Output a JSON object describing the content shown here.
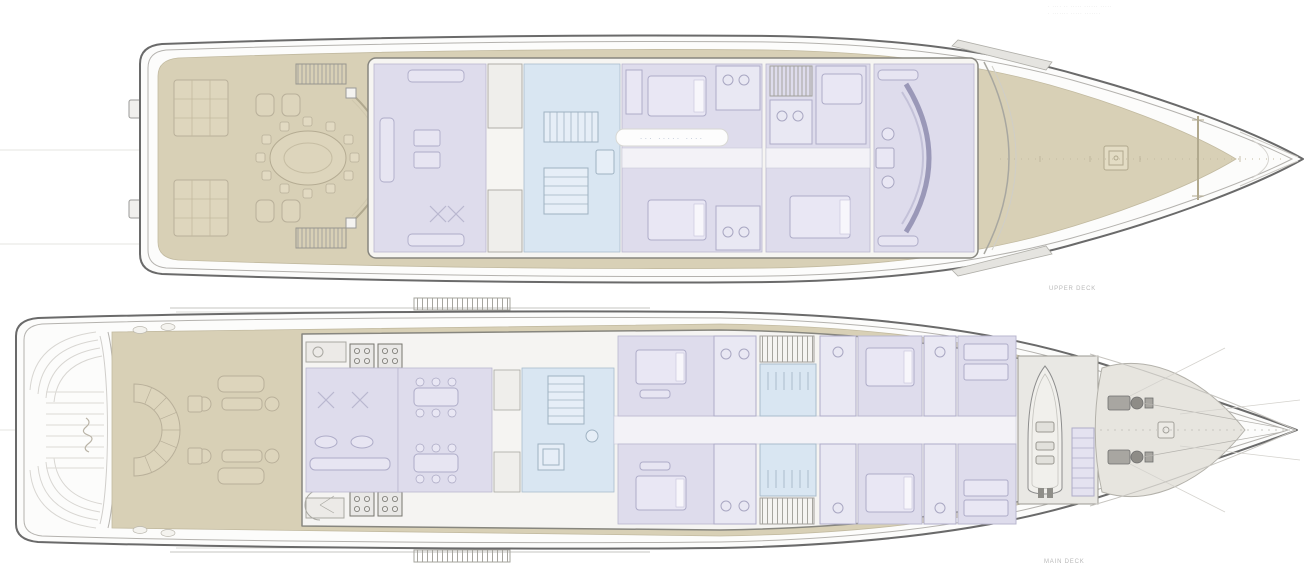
{
  "page": {
    "background": "#ffffff"
  },
  "annotations": {
    "corner_note_line_1": "· ···· ·· ····· ······ ·····",
    "corner_note_line_2": "· ······· ····· ·······",
    "watermark_text": "··· ····· ····"
  },
  "decks": {
    "upper": {
      "label": "UPPER DECK"
    },
    "main": {
      "label": "MAIN DECK"
    }
  },
  "colors": {
    "teak_deck": "#d8d0b6",
    "teak_furniture": "#ddd5bc",
    "interior_room": "#dedcec",
    "stair_lobby": "#d9e6f2",
    "corridor": "#f3f2f7",
    "hull_outline": "#6a6a6a",
    "machinery_gray": "#a8a6a1",
    "label_text": "#b9b9b9"
  }
}
